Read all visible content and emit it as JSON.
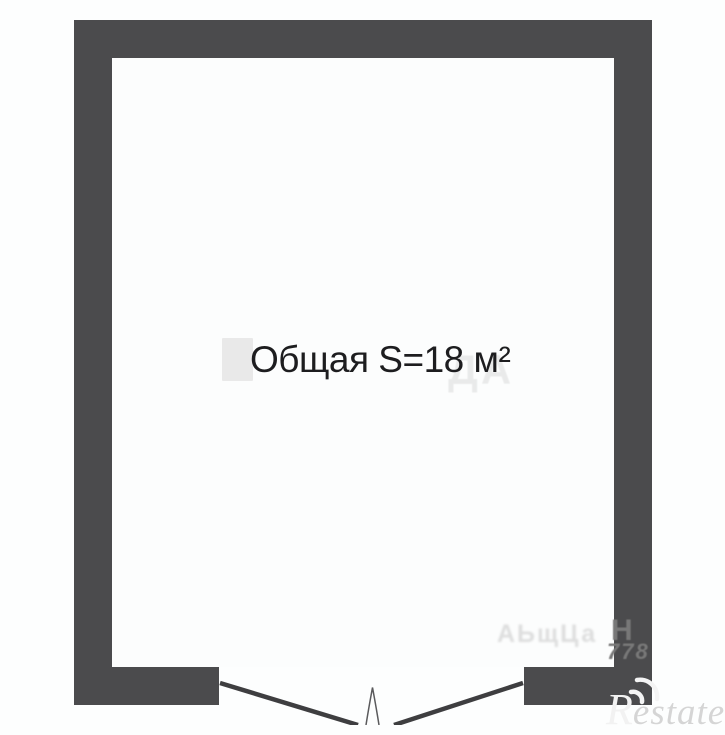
{
  "floorplan": {
    "room_label": "Общая S=18 м²",
    "area_value": "18",
    "area_unit": "м²"
  },
  "watermarks": {
    "center_ghost_text": "ДА",
    "bottom_smudge_text": "АЬщЦа",
    "wall_letter": "Н",
    "wall_digits": "778",
    "brand_first_letter": "R",
    "brand_rest": "estate"
  },
  "colors": {
    "wall": "#4b4b4d",
    "door_line": "#3e3e40",
    "background": "#fdfefe",
    "room_fill": "#fcfdfd",
    "label_text": "#1d1d1f",
    "ghost": "#e9e9e9",
    "brand_gray": "#d5d5d5",
    "brand_light": "#f2f2f2",
    "wall_watermark": "#787878"
  }
}
